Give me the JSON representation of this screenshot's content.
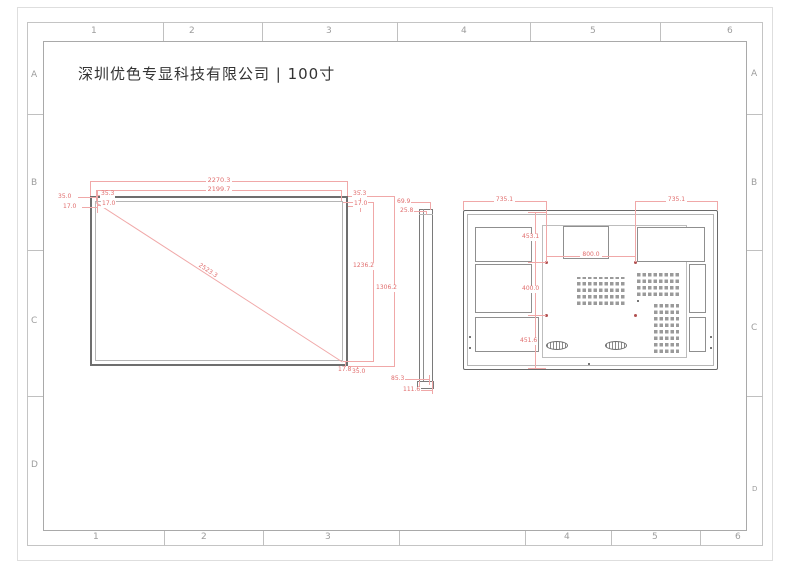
{
  "title": "深圳优色专显科技有限公司 | 100寸",
  "frame": {
    "cols_top": [
      "1",
      "2",
      "3",
      "4",
      "5",
      "6"
    ],
    "cols_bottom": [
      "1",
      "2",
      "3",
      "4",
      "5",
      "6"
    ],
    "rows_left": [
      "A",
      "B",
      "C",
      "D"
    ],
    "rows_right": [
      "A",
      "B",
      "C",
      "D"
    ]
  },
  "front": {
    "outer_width": "2270.3",
    "active_width": "2199.7",
    "diagonal": "2523.3",
    "active_height": "1236.2",
    "outer_height": "1306.2",
    "left_bezel": "35.0",
    "left_inner": "17.0",
    "top_bezel": "35.3",
    "top_inner": "17.0",
    "right_bezel": "35.3",
    "right_inner": "17.0",
    "bottom_inner": "17.8",
    "bottom_bezel": "35.0"
  },
  "side": {
    "top_depth": "69.9",
    "front_depth": "25.8",
    "body_depth": "85.3",
    "total_depth": "111.6"
  },
  "rear": {
    "left_offset": "735.1",
    "right_offset": "735.1",
    "vesa_width": "800.0",
    "top_offset": "453.1",
    "vesa_height": "400.0",
    "bottom_offset": "451.6"
  },
  "colors": {
    "dimension_red": "#e06c6c",
    "dimension_line": "#f0a8a8",
    "drawing_gray": "#8d8d8d",
    "frame_gray": "#c4c4c4"
  }
}
